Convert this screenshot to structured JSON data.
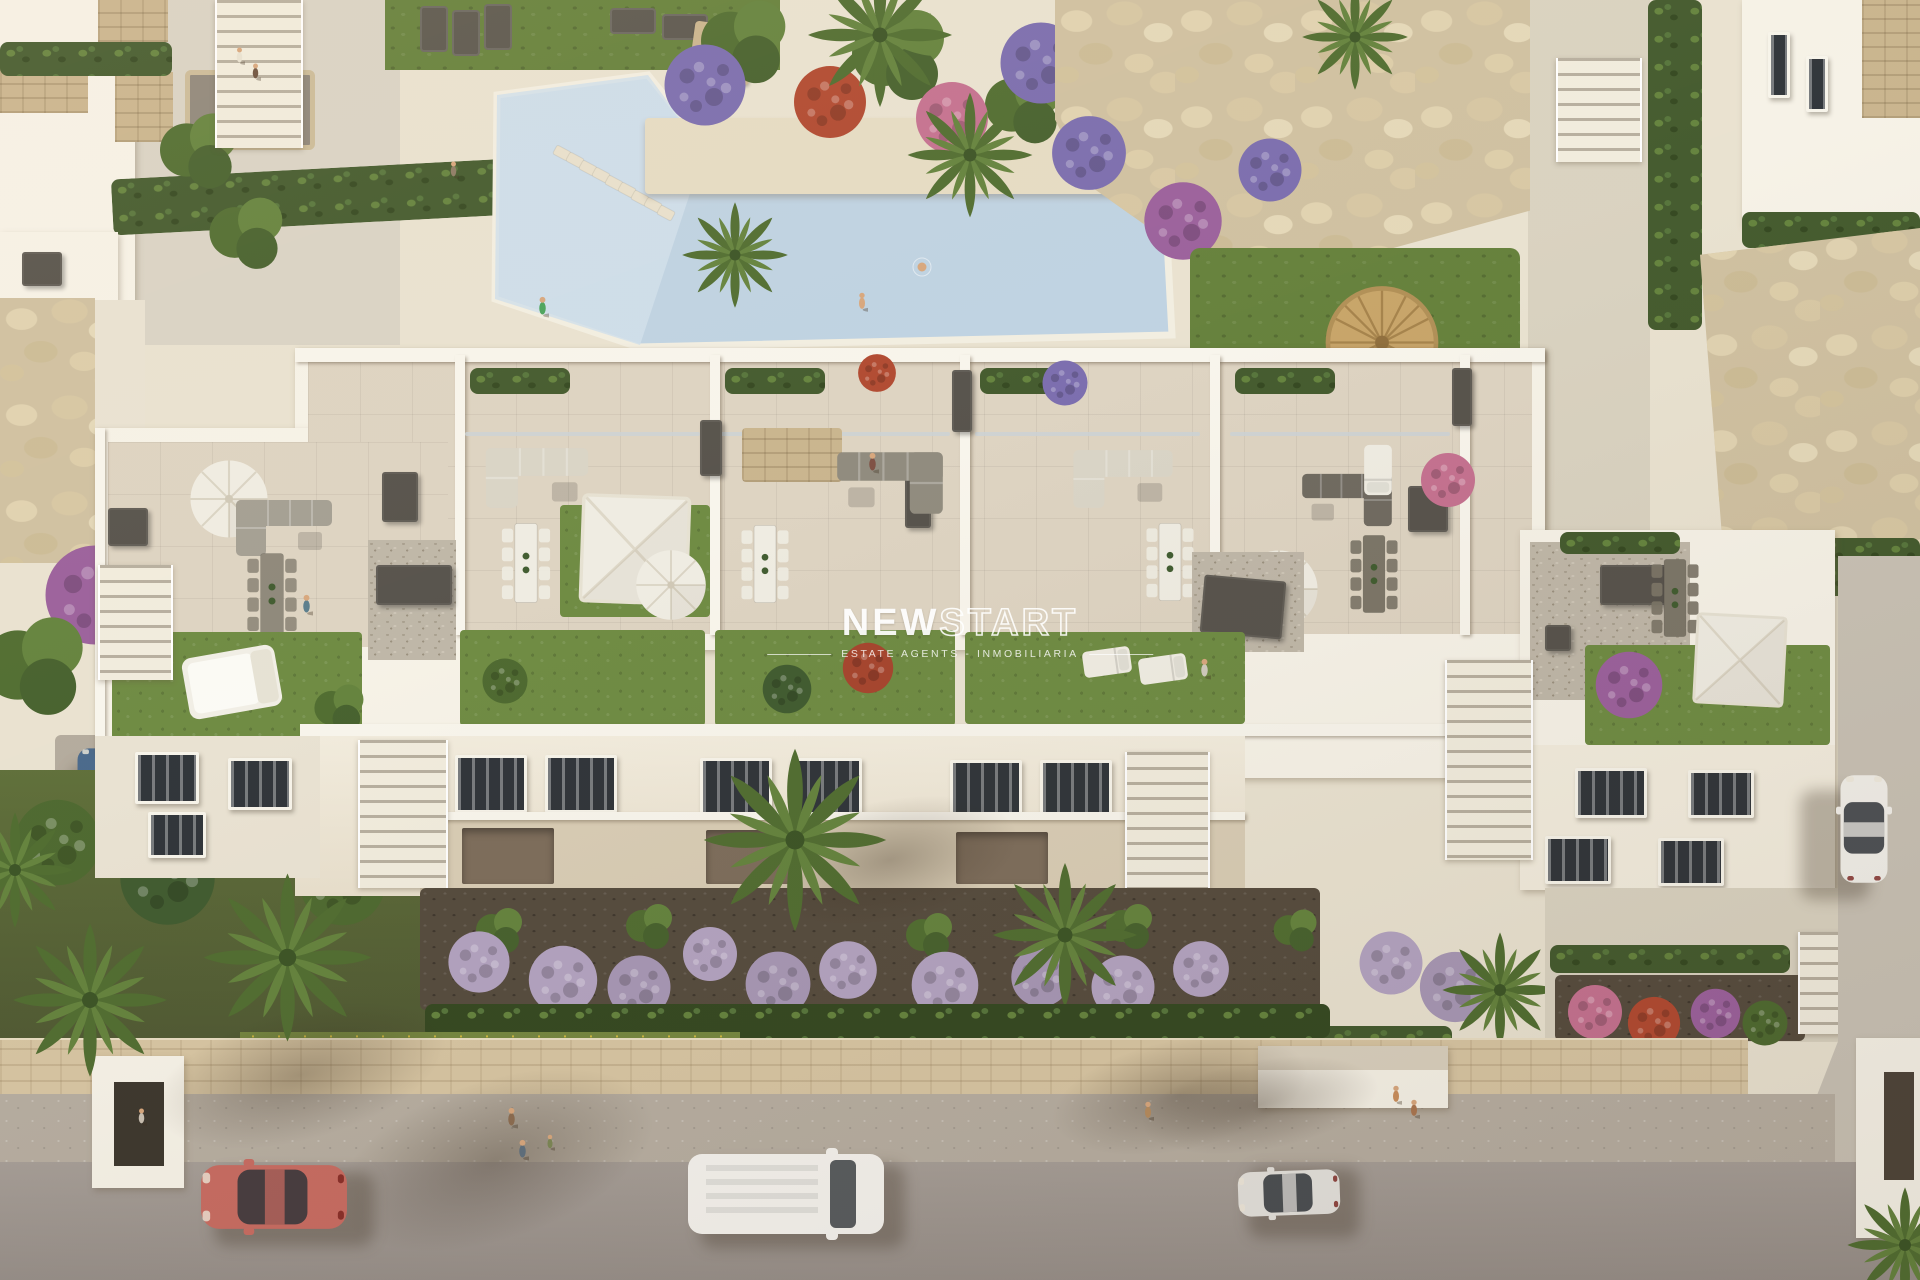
{
  "image": {
    "kind": "aerial 3D architectural render",
    "subject": "White Mediterranean apartment block with rooftop solarium terraces, communal swimming pool, landscaped gardens and a street with parked cars and pedestrians",
    "lighting": "warm low sun with long shadows"
  },
  "watermark": {
    "brand_solid": "NEW",
    "brand_outline": "START",
    "tagline": "ESTATE AGENTS - INMOBILIARIA"
  },
  "scene_objects": [
    "swimming-pool",
    "pool-sun-deck",
    "planter-island-with-palms",
    "rock-garden",
    "rooftop-terraces",
    "roof-lawns",
    "parasols",
    "shade-sails",
    "outdoor-sofas",
    "dining-sets",
    "sun-loungers",
    "daybed",
    "apartment-facade",
    "staircases",
    "front-gardens",
    "lavender-bushes",
    "palm-trees",
    "perimeter-stone-wall",
    "sidewalk",
    "street",
    "red-car",
    "white-van",
    "silver-car",
    "blue-car",
    "white-parked-car",
    "pedestrians",
    "neighbour-villas",
    "entrance-canopy",
    "straw-umbrella"
  ],
  "colors": {
    "buildingWhite": "#f6f2e7",
    "buildingShade": "#e9e2d2",
    "facade": "#f2ecdd",
    "facadeShade": "#d8ccb4",
    "tile": "#ddd3c1",
    "deck": "#e9e2d0",
    "path": "#d9d2c0",
    "poolRim": "#f2eee1",
    "poolWater": "#bed2e2",
    "poolShallow": "#d0dfeb",
    "roofLawn": "#6d8a41",
    "grass": "#64803a",
    "hedge": "#42592c",
    "hedgeDark": "#33471f",
    "soil": "#544a3c",
    "gravel": "#beb6a7",
    "rocks": "#cfc0a0",
    "cobble": "#d7c5a2",
    "sidewalk": "#b6ada0",
    "road": "#a59d96",
    "darkBox": "#55514a",
    "furnWhite": "#efece2",
    "sofaGrey": "#95907f",
    "travertine": "#c9b48d",
    "lavender": "#b2a2c0",
    "flowerPurple": "#7a6cae",
    "flowerRed": "#b0482f",
    "flowerPink": "#c4708f",
    "bougainvillea": "#9a5f9b",
    "bushGreen": "#4c682e",
    "palm1": "#4f6c2f",
    "palm2": "#63823c",
    "palm3": "#3a5324",
    "carRed": "#c76a60",
    "carBlue": "#49688a",
    "carSilver": "#e4e2dd",
    "carWhite": "#f1efe9",
    "vanWhite": "#f5f3ee",
    "glass": "#2e3338",
    "skin": "#d7a67c",
    "strawTan": "#c7a468",
    "watermark": "#ffffff"
  }
}
